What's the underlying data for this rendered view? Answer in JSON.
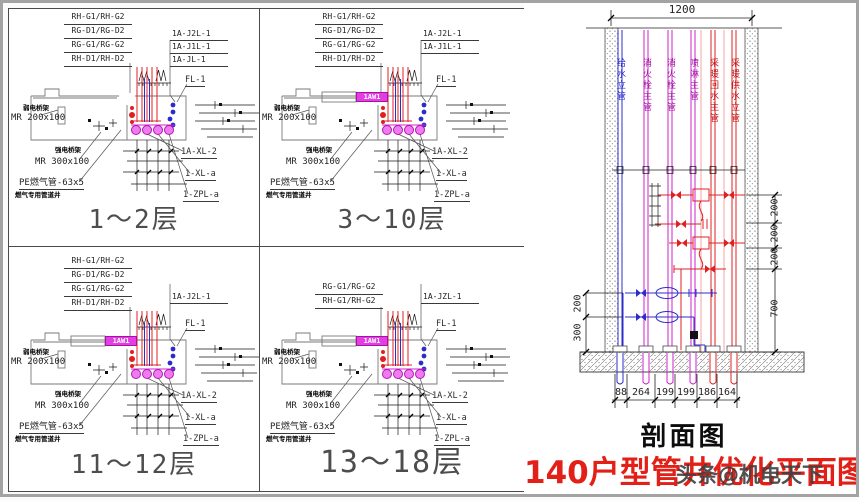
{
  "quadrants": [
    {
      "title": "1～2层",
      "stack": [
        "RH-G1/RH-G2",
        "RG-D1/RG-D2",
        "RG-G1/RG-G2",
        "RH-D1/RH-D2"
      ],
      "risers": [
        "1A-J2L-1",
        "1A-J1L-1",
        "1A-JL-1"
      ],
      "fl": "FL-1",
      "tray1_note": "弱电桥架",
      "tray1": "MR 200x100",
      "tray2_note": "强电桥架",
      "tray2": "MR 300x100",
      "pe": "PE燃气管-63x5",
      "pe_note": "燃气专用管道井",
      "outlets": [
        "1A-XL-2",
        "1-XL-a",
        "1-ZPL-a"
      ]
    },
    {
      "title": "3～10层",
      "stack": [
        "RH-G1/RH-G2",
        "RG-D1/RG-D2",
        "RG-G1/RG-G2",
        "RH-D1/RH-D2"
      ],
      "risers": [
        "1A-J2L-1",
        "1A-J1L-1"
      ],
      "fl": "FL-1",
      "duct": "1AW1",
      "tray1_note": "弱电桥架",
      "tray1": "MR 200x100",
      "tray2_note": "强电桥架",
      "tray2": "MR 300x100",
      "pe": "PE燃气管-63x5",
      "pe_note": "燃气专用管道井",
      "outlets": [
        "1A-XL-2",
        "1-XL-a",
        "1-ZPL-a"
      ]
    },
    {
      "title": "11～12层",
      "stack": [
        "RH-G1/RH-G2",
        "RG-D1/RG-D2",
        "RG-G1/RG-G2",
        "RH-D1/RH-D2"
      ],
      "risers": [
        "1A-J2L-1"
      ],
      "fl": "FL-1",
      "duct": "1AW1",
      "tray1_note": "弱电桥架",
      "tray1": "MR 200x100",
      "tray2_note": "强电桥架",
      "tray2": "MR 300x100",
      "pe": "PE燃气管-63x5",
      "pe_note": "燃气专用管道井",
      "outlets": [
        "1A-XL-2",
        "1-XL-a",
        "1-ZPL-a"
      ]
    },
    {
      "title": "13～18层",
      "stack": [
        "RG-G1/RG-G2",
        "RH-G1/RH-G2"
      ],
      "risers": [
        "1A-JZL-1"
      ],
      "fl": "FL-1",
      "duct": "1AW1",
      "tray1_note": "弱电桥架",
      "tray1": "MR 200x100",
      "tray2_note": "强电桥架",
      "tray2": "MR 300x100",
      "pe": "PE燃气管-63x5",
      "pe_note": "燃气专用管道井",
      "outlets": [
        "1A-XL-2",
        "1-XL-a",
        "1-ZPL-a"
      ]
    }
  ],
  "section": {
    "caption": "剖面图",
    "width_dim": "1200",
    "pipes": [
      {
        "label": "给水立管",
        "color": "#2c2ccc"
      },
      {
        "label": "消火栓主管",
        "color": "#cc22cc"
      },
      {
        "label": "消火栓主管",
        "color": "#cc22cc"
      },
      {
        "label": "喷淋主管",
        "color": "#cc22cc"
      },
      {
        "label": "采暖回水主管",
        "color": "#e02020"
      },
      {
        "label": "采暖供水立管",
        "color": "#e02020"
      }
    ],
    "right_dims": [
      "200",
      "200",
      "200",
      "700"
    ],
    "left_dims": [
      "200",
      "300"
    ],
    "bottom_dims": [
      "88",
      "264",
      "199",
      "199",
      "186",
      "164"
    ]
  },
  "footer": {
    "red_title": "140户型管井优化平面图",
    "watermark": "头条@机电天下"
  },
  "colors": {
    "pipe_red": "#e02020",
    "pipe_magenta": "#cc22cc",
    "pipe_blue": "#2c2ccc",
    "title_red": "#e32017",
    "line": "#3a3a3a",
    "wall_gray": "#7a7a7a"
  }
}
